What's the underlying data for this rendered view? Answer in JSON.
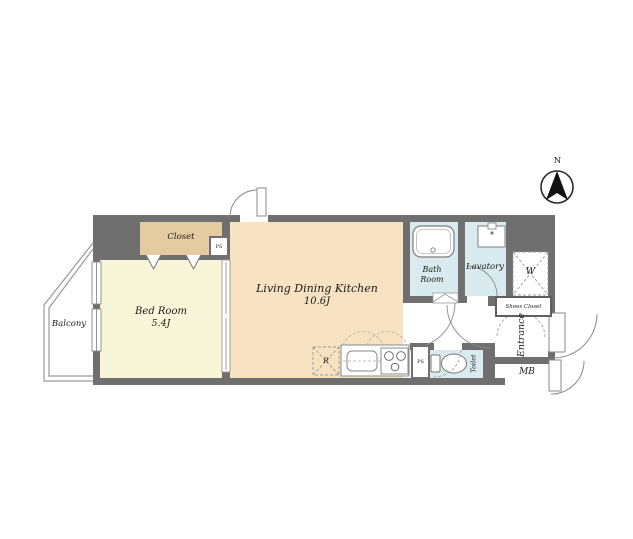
{
  "compass": {
    "north_label": "N"
  },
  "rooms": {
    "balcony": {
      "label": "Balcony"
    },
    "closet": {
      "label": "Closet"
    },
    "bedroom": {
      "label": "Bed Room",
      "size": "5.4J"
    },
    "ldk": {
      "label": "Living Dining Kitchen",
      "size": "10.6J"
    },
    "bath": {
      "label": "Bath Room"
    },
    "lavatory": {
      "label": "Lavatory"
    },
    "washer_space": {
      "label": "W"
    },
    "shoes_closet": {
      "label": "Shoes Closet"
    },
    "entrance": {
      "label": "Entrance"
    },
    "toilet": {
      "label": "Toilet"
    },
    "meter_box": {
      "label": "MB"
    }
  },
  "fixtures": {
    "refrigerator": {
      "label": "R"
    },
    "pipe_space_closet": {
      "label": "PS"
    },
    "pipe_space_kitchen": {
      "label": "PS"
    }
  },
  "colors": {
    "wall": "#6F6F6F",
    "bedroom_fill": "#F8F5D8",
    "closet_fill": "#E5CBA0",
    "ldk_fill": "#F7E2C2",
    "wet_area_fill": "#D9EBEE",
    "line": "#888888",
    "text": "#1B1B1B"
  }
}
